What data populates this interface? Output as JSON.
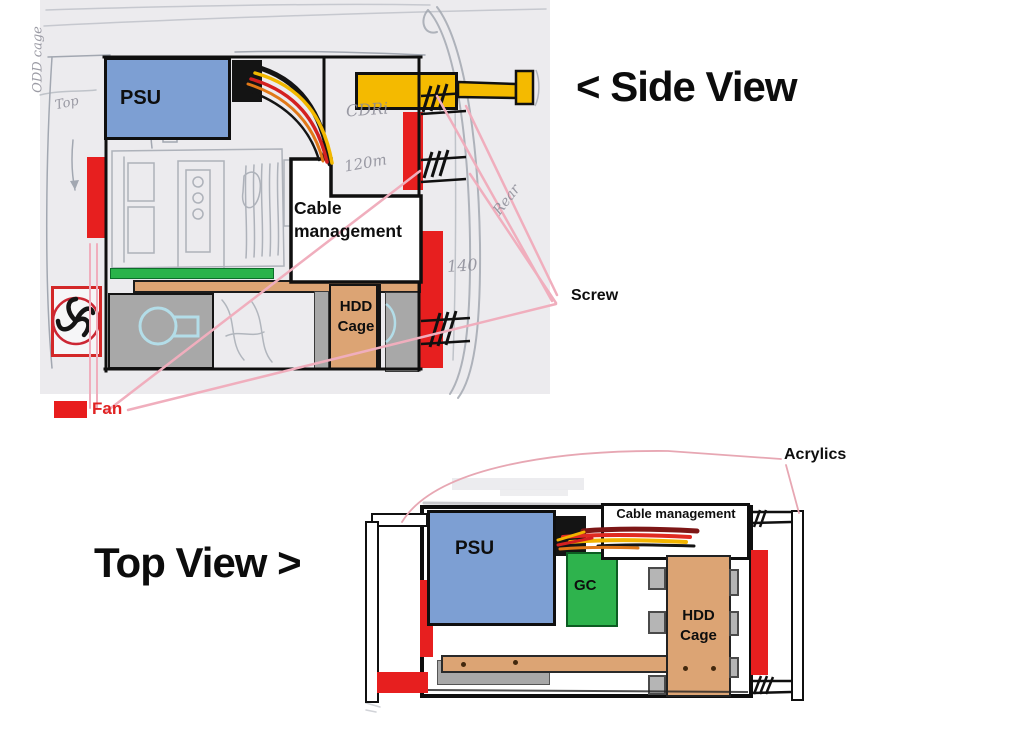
{
  "side_view": {
    "heading": "< Side View",
    "psu_label": "PSU",
    "cable_management_label": "Cable management",
    "hdd_cage_label": "HDD Cage",
    "screw_label": "Screw",
    "fan_label": "Fan",
    "handwritten": {
      "odd_cage": "ODD cage",
      "top": "Top",
      "cdri": "CDRi",
      "fan_120": "120m",
      "fan_140": "140",
      "rear": "Rear"
    }
  },
  "top_view": {
    "heading": "Top View >",
    "psu_label": "PSU",
    "gc_label": "GC",
    "cable_management_label": "Cable management",
    "hdd_cage_label": "HDD Cage",
    "acrylics_label": "Acrylics"
  },
  "colors": {
    "psu_blue": "#7d9fd3",
    "odd_yellow": "#f4ba00",
    "fan_red": "#e81d1d",
    "gpu_green": "#2ab34a",
    "gc_green": "#2eb34d",
    "hdd_tan": "#dca474",
    "gray_bracket": "#a8a8a8",
    "pencil": "#9aa0aa",
    "pink_leader": "#f0aebd",
    "fan_text_red": "#e02222"
  }
}
